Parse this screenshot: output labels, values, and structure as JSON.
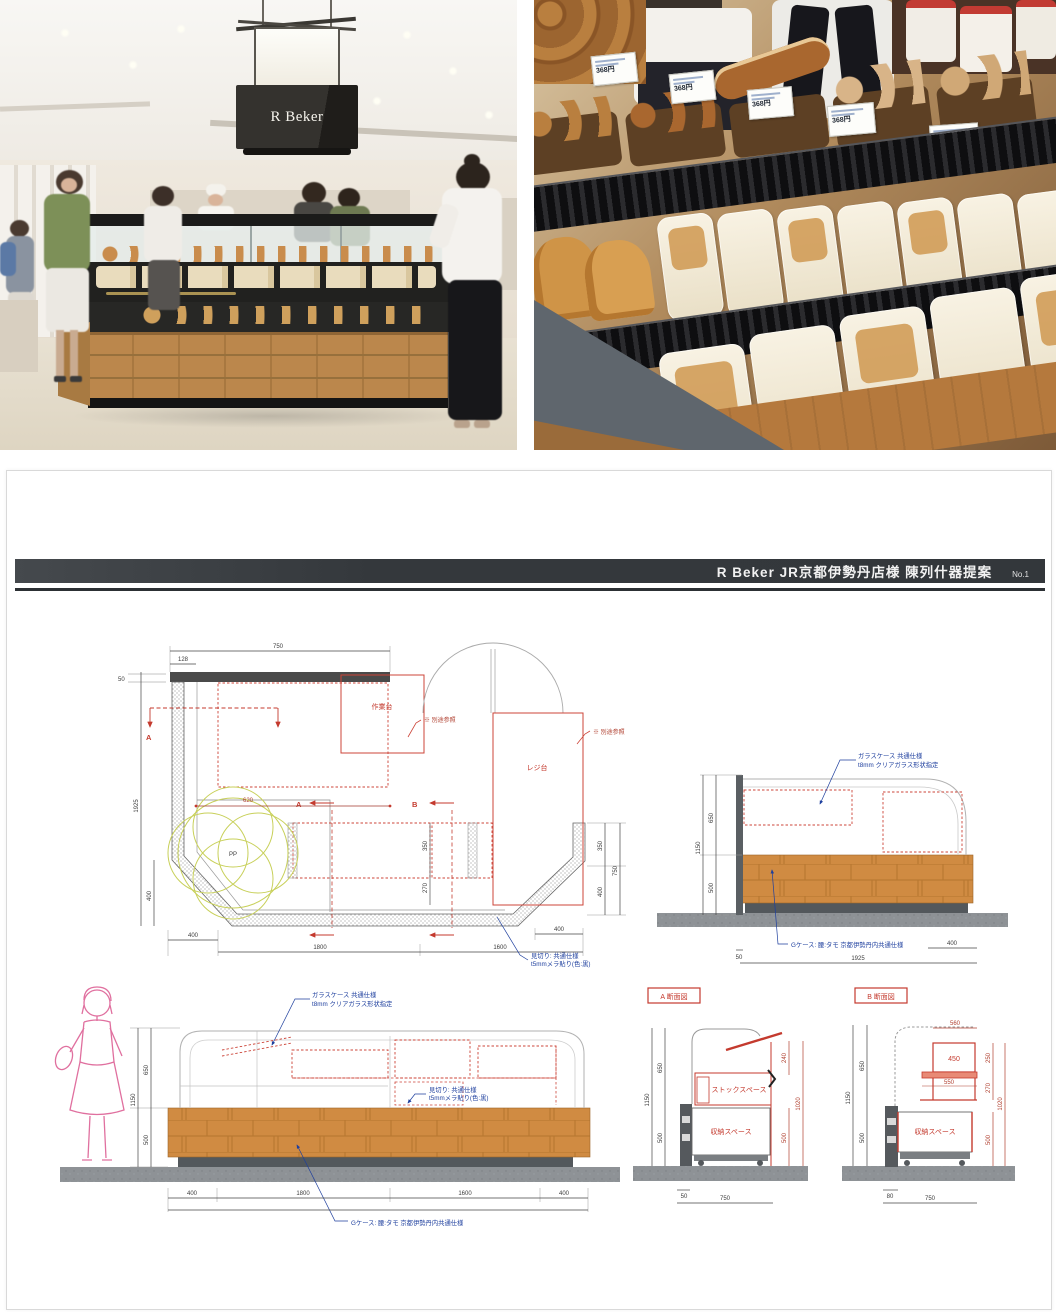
{
  "photos": {
    "left": {
      "sign_text": "R Beker"
    },
    "right": {
      "price_label": "368円"
    }
  },
  "sheet": {
    "title": "R Beker JR京都伊勢丹店様 陳列什器提案",
    "page_no": "No.1",
    "notes": {
      "glass_1": "ガラスケース 共通仕様",
      "glass_2": "t8mm クリアガラス形状指定",
      "cut_1": "見切り: 共通仕様",
      "cut_2": "t5mmメラ貼り(色:黒)",
      "base": "Gケース: 腰:タモ 京都伊勢丹内共通仕様"
    },
    "plan": {
      "labels": {
        "work_table": "作業台",
        "register": "レジ台",
        "pp": "PP",
        "ref": "※ 別途参照",
        "a": "A",
        "b": "B"
      },
      "dims": {
        "top": "750",
        "top_sub": "128",
        "tiny": "50",
        "left": "1925",
        "left_low": "400",
        "inner": "620",
        "mid_d1": "350",
        "mid_d2": "270",
        "right_d1": "350",
        "right_d2": "400",
        "right_total": "750",
        "chamfer_l": "400",
        "bottom_1": "1800",
        "bottom_2": "1600",
        "chamfer_r": "400"
      }
    },
    "elev_side": {
      "dims": {
        "h_total": "1150",
        "h_upper": "650",
        "h_lower": "500",
        "off": "50",
        "width": "1925",
        "right": "400"
      }
    },
    "elev_front": {
      "dims": {
        "h_total": "1150",
        "h_upper": "650",
        "h_lower": "500",
        "b1": "400",
        "b2": "1800",
        "b3": "1600",
        "b4": "400"
      }
    },
    "section_a": {
      "title": "A 断面図",
      "stock": "ストックスペース",
      "storage": "収納スペース",
      "dims": {
        "h_total": "1150",
        "h_upper": "650",
        "h_lower": "500",
        "r1": "240",
        "r2": "1020",
        "r3": "500",
        "off": "50",
        "width": "750"
      }
    },
    "section_b": {
      "title": "B 断面図",
      "storage": "収納スペース",
      "shelf_1": "450",
      "shelf_2": "550",
      "top": "560",
      "dims": {
        "h_total": "1150",
        "h_upper": "650",
        "h_lower": "500",
        "r1": "250",
        "r2": "270",
        "r3": "1020",
        "r4": "500",
        "off": "80",
        "width": "750"
      }
    }
  }
}
